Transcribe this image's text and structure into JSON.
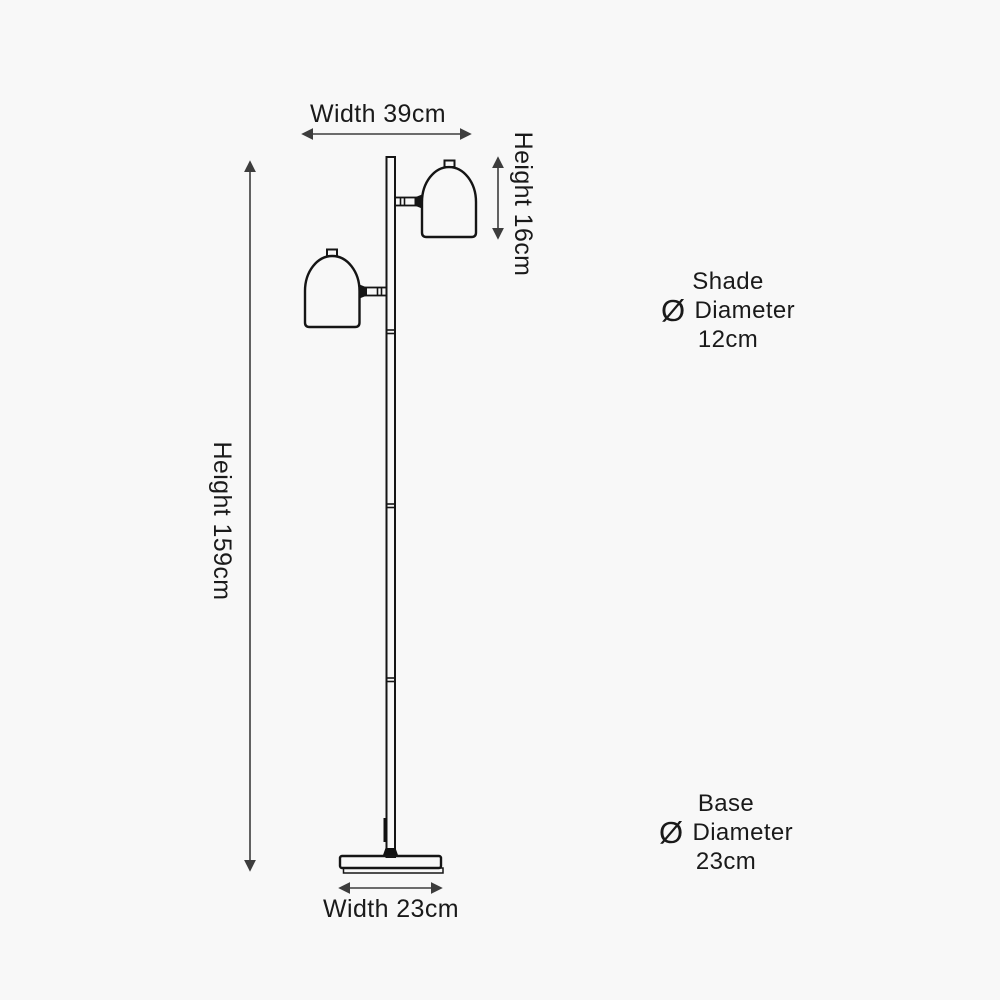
{
  "meta": {
    "title": "Floor lamp dimensions diagram",
    "background_color": "#f8f8f8",
    "outline_color": "#151515",
    "dimension_line_color": "#3d3d3d",
    "text_color": "#1a1a1a"
  },
  "dimensions": {
    "top_width": {
      "label": "Width 39cm"
    },
    "overall_height": {
      "label": "Height 159cm"
    },
    "shade_height": {
      "label": "Height 16cm"
    },
    "bottom_width": {
      "label": "Width 23cm"
    }
  },
  "annotations": {
    "shade": {
      "title": "Shade",
      "symbol": "Ø",
      "diameter_word": "Diameter",
      "value": "12cm"
    },
    "base": {
      "title": "Base",
      "symbol": "Ø",
      "diameter_word": "Diameter",
      "value": "23cm"
    }
  }
}
